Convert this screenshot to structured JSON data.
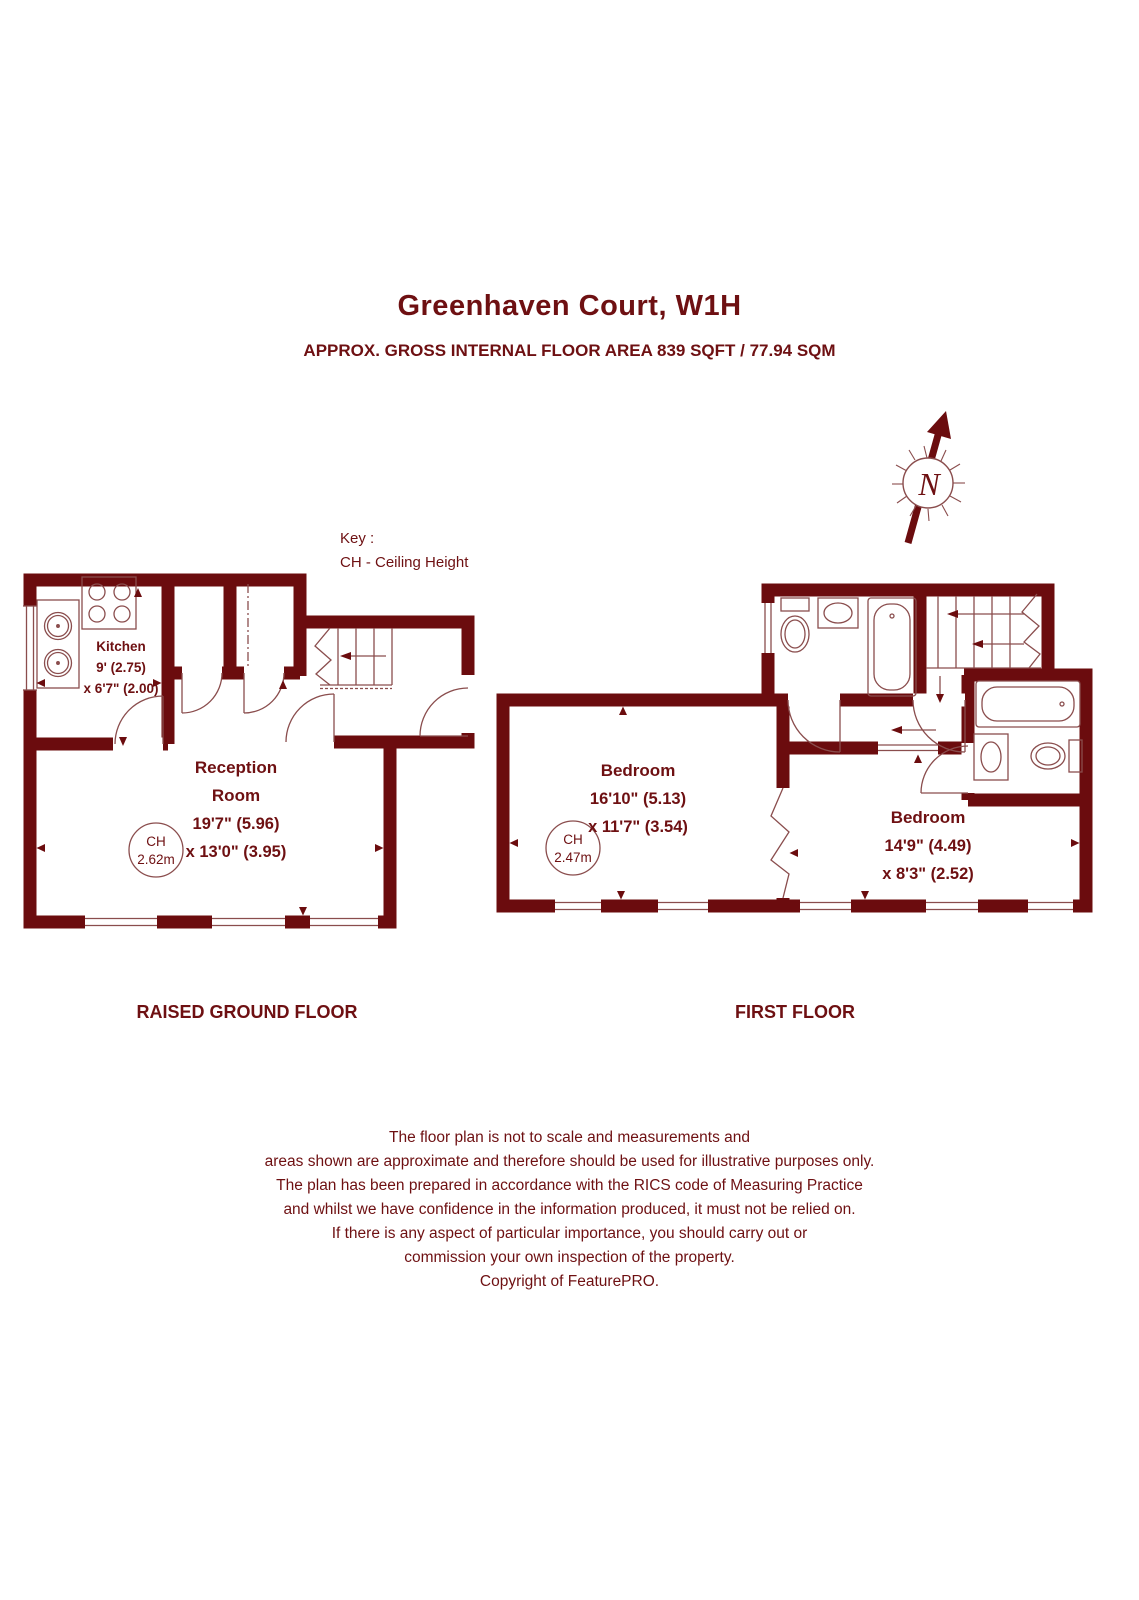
{
  "colors": {
    "wall": "#6b0c0e",
    "thin_line": "#8a4d4d",
    "text": "#6e1012"
  },
  "header": {
    "title": "Greenhaven Court, W1H",
    "subtitle": "APPROX. GROSS INTERNAL FLOOR AREA 839 SQFT / 77.94 SQM"
  },
  "key": {
    "title": "Key :",
    "entry": "CH - Ceiling Height"
  },
  "north": {
    "label": "N"
  },
  "ground_floor": {
    "label": "RAISED GROUND FLOOR",
    "kitchen": {
      "name": "Kitchen",
      "dim1": "9' (2.75)",
      "dim2": "x 6'7\" (2.00)"
    },
    "reception": {
      "name_line1": "Reception",
      "name_line2": "Room",
      "dim1": "19'7\" (5.96)",
      "dim2": "x 13'0\" (3.95)"
    },
    "ceiling_height": {
      "label": "CH",
      "value": "2.62m"
    }
  },
  "first_floor": {
    "label": "FIRST FLOOR",
    "bedroom1": {
      "name": "Bedroom",
      "dim1": "16'10\" (5.13)",
      "dim2": "x 11'7\" (3.54)"
    },
    "bedroom2": {
      "name": "Bedroom",
      "dim1": "14'9\" (4.49)",
      "dim2": "x 8'3\" (2.52)"
    },
    "ceiling_height": {
      "label": "CH",
      "value": "2.47m"
    }
  },
  "disclaimer": {
    "lines": [
      "The floor plan is not to scale and measurements and",
      "areas shown are approximate and therefore should be used for illustrative purposes only.",
      "The plan has been prepared in accordance with the RICS code of Measuring Practice",
      "and whilst we have confidence in the information produced, it must not be relied on.",
      "If there is any aspect of particular importance, you should carry out or",
      "commission your own inspection of the property.",
      "Copyright of FeaturePRO."
    ]
  }
}
